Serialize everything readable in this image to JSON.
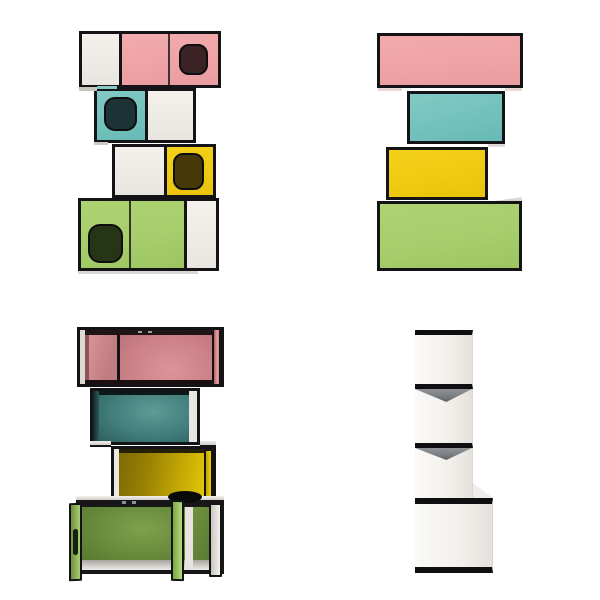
{
  "canvas": {
    "width": 600,
    "height": 600,
    "background": "#ffffff"
  },
  "product": {
    "kind": "modular stacked pet cabinet shown from four angles",
    "tiers": [
      {
        "position": "top",
        "color_name": "pink",
        "hex": "#efa4a7"
      },
      {
        "position": "second",
        "color_name": "teal",
        "hex": "#74c2be"
      },
      {
        "position": "third",
        "color_name": "yellow",
        "hex": "#f0ca10"
      },
      {
        "position": "bottom",
        "color_name": "green",
        "hex": "#a7cd6c"
      }
    ]
  },
  "views": {
    "front": "front-closed",
    "back": "back",
    "open": "front-open-doors",
    "side": "side-profile"
  },
  "palette": {
    "frame": "#141416",
    "pink": "#efa4a7",
    "pink-dark": "#cc8287",
    "pink-door": "#e69b9f",
    "teal": "#74c2be",
    "teal-dark": "#417e7c",
    "yellow": "#f0ca10",
    "yellow-dark": "#9a8204",
    "yellow-door": "#f4d105",
    "green": "#a7cd6c",
    "green-dark": "#628538",
    "green-door": "#a9cf70",
    "panel-white": "#f1eeea",
    "hole-pink": "#3b2225",
    "hole-teal": "#1c3335",
    "hole-yellow": "#473808",
    "hole-green": "#263516",
    "side-gray": "#7b7f84"
  }
}
